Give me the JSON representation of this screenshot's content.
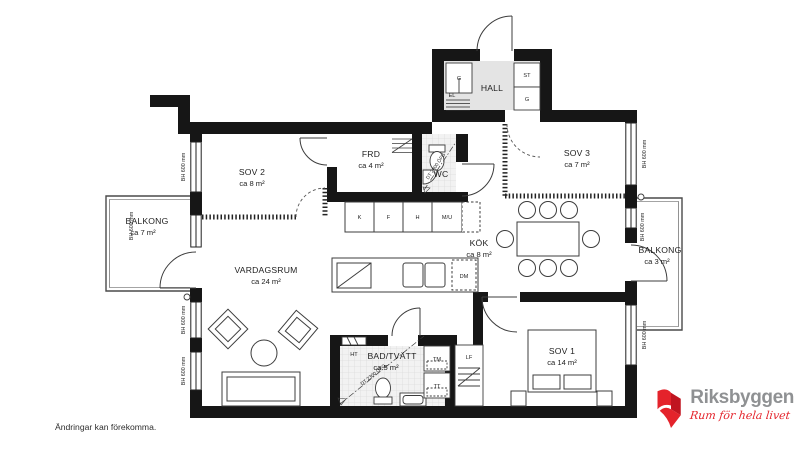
{
  "rooms": {
    "hall": {
      "name": "HALL"
    },
    "wc": {
      "name": "WC"
    },
    "frd": {
      "name": "FRD",
      "area": "ca 4 m²"
    },
    "sov1": {
      "name": "SOV 1",
      "area": "ca 14 m²"
    },
    "sov2": {
      "name": "SOV 2",
      "area": "ca 8 m²"
    },
    "sov3": {
      "name": "SOV 3",
      "area": "ca 7 m²"
    },
    "kok": {
      "name": "KÖK",
      "area": "ca 8 m²"
    },
    "vardagsrum": {
      "name": "VARDAGSRUM",
      "area": "ca 24 m²"
    },
    "bad": {
      "name": "BAD/TVÄTT",
      "area": "ca 5 m²"
    },
    "balkong_vast": {
      "name": "BALKONG",
      "area": "ca 7 m²"
    },
    "balkong_ost": {
      "name": "BALKONG",
      "area": "ca 3 m²"
    }
  },
  "labels": {
    "window_height": "BH 600 mm",
    "ceiling_height": "DT 2300 ÖFG",
    "el": "EL",
    "ht": "HT",
    "tm": "TM",
    "tt": "TT",
    "lf": "LF",
    "dm": "DM",
    "closet_g": "G",
    "closet_st": "ST",
    "closet_g2": "G",
    "kitchen_cabinets": [
      "K",
      "F",
      "H",
      "M/U"
    ]
  },
  "footer": {
    "disclaimer": "Ändringar kan förekomma."
  },
  "logo": {
    "name": "Riksbyggen",
    "tagline": "Rum för hela livet"
  },
  "colors": {
    "wall": "#161616",
    "brand_red": "#e4232b",
    "logo_gray": "#8f9193"
  }
}
